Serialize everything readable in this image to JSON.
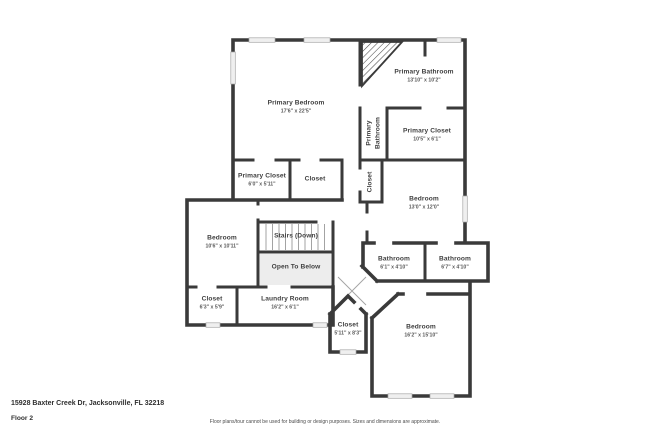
{
  "plan": {
    "rooms": {
      "primary_bedroom": {
        "name": "Primary Bedroom",
        "dims": "17'6\" x 22'5\""
      },
      "primary_bathroom": {
        "name": "Primary Bathroom",
        "dims": "13'10\" x 10'2\""
      },
      "primary_bathroom_wc": {
        "name": "Primary Bathroom"
      },
      "primary_closet_right": {
        "name": "Primary Closet",
        "dims": "10'5\" x 6'1\""
      },
      "primary_closet_left": {
        "name": "Primary Closet",
        "dims": "6'0\" x 5'11\""
      },
      "closet_top": {
        "name": "Closet"
      },
      "closet_hall": {
        "name": "Closet"
      },
      "bedroom_left": {
        "name": "Bedroom",
        "dims": "10'6\" x 10'11\""
      },
      "stairs": {
        "name": "Stairs (Down)"
      },
      "open_to_below": {
        "name": "Open To Below"
      },
      "bedroom_right": {
        "name": "Bedroom",
        "dims": "13'0\" x 12'0\""
      },
      "bathroom_left": {
        "name": "Bathroom",
        "dims": "6'1\" x 4'10\""
      },
      "bathroom_right": {
        "name": "Bathroom",
        "dims": "6'7\" x 4'10\""
      },
      "closet_bottom_left": {
        "name": "Closet",
        "dims": "6'3\" x 5'9\""
      },
      "laundry_room": {
        "name": "Laundry Room",
        "dims": "16'2\" x 6'1\""
      },
      "closet_bottom": {
        "name": "Closet",
        "dims": "5'11\" x 8'3\""
      },
      "bedroom_bottom": {
        "name": "Bedroom",
        "dims": "16'2\" x 15'10\""
      }
    }
  },
  "footer": {
    "address": "15928 Baxter Creek Dr, Jacksonville, FL 32218",
    "floor_label": "Floor 2",
    "disclaimer": "Floor plans/tour cannot be used for building or design purposes. Sizes and dimensions are approximate."
  },
  "colors": {
    "wall": "#3a3a3a",
    "window_fill": "#efefef",
    "open_area_fill": "#ededed",
    "tread": "#9a9a9a",
    "label_text": "#3f3f3f"
  }
}
